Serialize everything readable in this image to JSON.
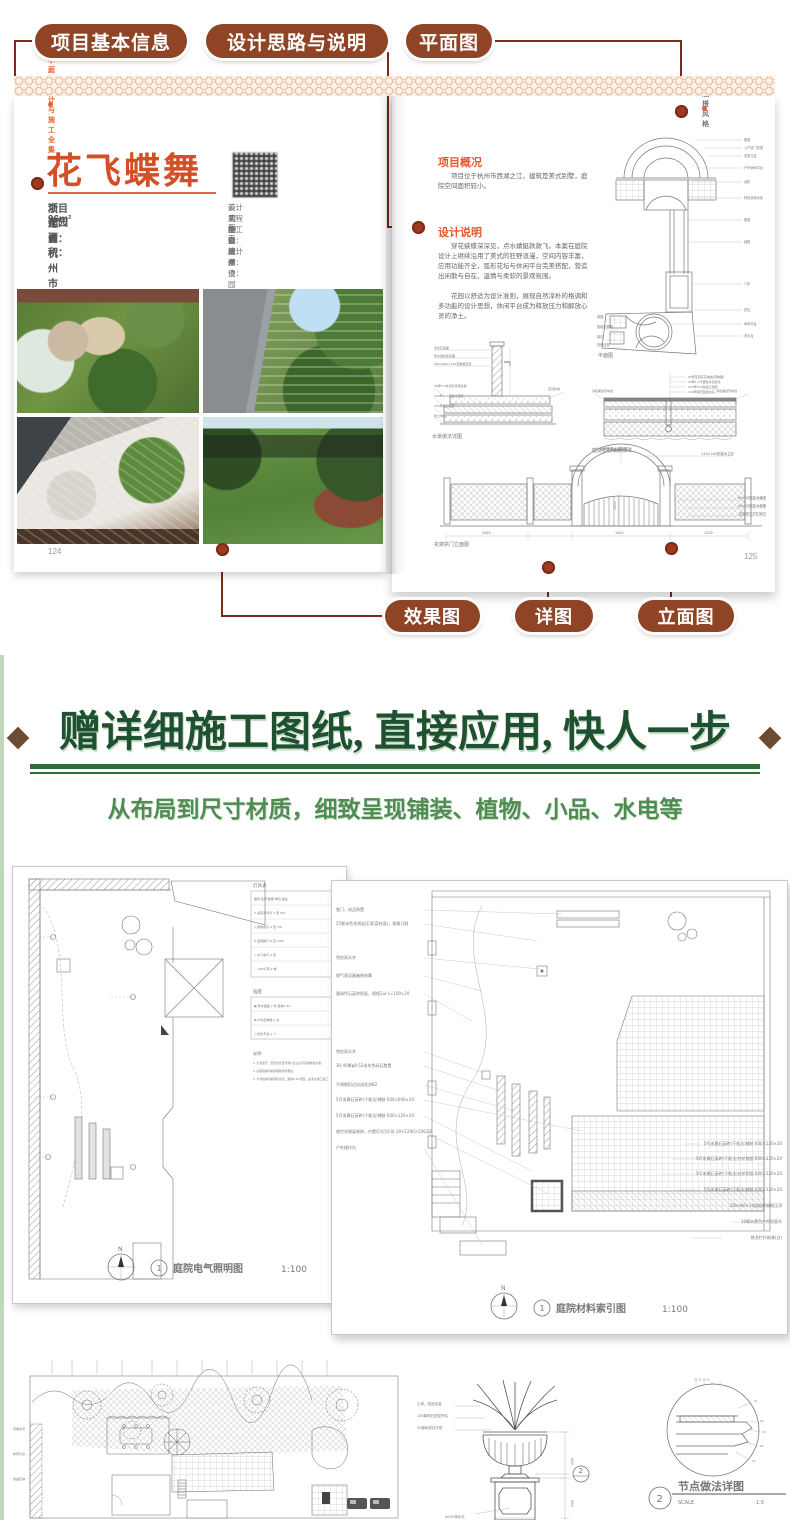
{
  "colors": {
    "pill": "#8e4425",
    "connector": "#7a2b19",
    "accent_orange": "#e25a2d",
    "title_red": "#d34f28",
    "headline_green": "#1d5130",
    "subtitle_green": "#4e8c52",
    "rule_green": "#2c6b3c",
    "diamond_brown": "#6b4c33"
  },
  "callouts": {
    "top": [
      "项目基本信息",
      "设计思路与说明",
      "平面图"
    ],
    "bottom": [
      "效果图",
      "详图",
      "立面图"
    ]
  },
  "book": {
    "left_page": {
      "header": "小庭院设计与施工全集",
      "title": "花飞蝶舞",
      "info": [
        {
          "label": "项目地点：",
          "value": "浙江省杭州市"
        },
        {
          "label": "花园面积：",
          "value": "96m²"
        }
      ],
      "specs": [
        {
          "label": "设计风格：",
          "value": "美式混搭"
        },
        {
          "label": "工程造价：",
          "value": "12 万"
        },
        {
          "label": "施工周期：",
          "value": "60 天"
        },
        {
          "label": "设 计 师：",
          "value": "张成度"
        },
        {
          "label": "设计单位：",
          "value": "杭州漫园园林工程有限公司"
        }
      ],
      "page_number": "124"
    },
    "right_page": {
      "header": "混搭风格",
      "overview_heading": "项目概况",
      "overview_text": "项目位于杭州市西湖之江，建筑是美式别墅，庭院空间面积较小。",
      "design_heading": "设计说明",
      "design_para1": "穿花蛱蝶深深见，点水蜻蜓款款飞。本案在庭院设计上继续沿用了美式的狂野浪漫，空间内容丰富，应用功能齐全，弧形花坛与休闲平台完美搭配，营造出闲散与自在、温情与柔软的景观氛围。",
      "design_para2": "花园以舒适为设计准则，展现自然淳朴的格调和多功能的设计思想，休闲平台成为释放压力和解放心灵的净土。",
      "page_number": "125"
    }
  },
  "plan": {
    "caption": "平面图",
    "labels_right": [
      "围墙",
      "入户拱门花架",
      "花架立柱",
      "户外休闲平台",
      "台阶",
      "特色景墙水景",
      "围墙",
      "绿篱",
      "汀步",
      "花坛",
      "休闲平台",
      "洗手台"
    ],
    "labels_left": [
      "菜园",
      "智能信报箱",
      "置石",
      "特色坐凳"
    ]
  },
  "water": {
    "caption": "水景做法详图",
    "labels_left": [
      "文化石贴面",
      "防水层拉毛处理",
      "200×600×120花岗岩压顶"
    ],
    "labels_bottom": [
      "30厚1:3水泥砂浆结合层",
      "100厚C15混凝土垫层",
      "150厚碎石垫层",
      "素土夯实"
    ],
    "label_right": "压顶找坡"
  },
  "paving": {
    "caption": "庭院石材铺装做法",
    "labels_top": [
      "50厚芝麻灰花岗岩(荔枝面)",
      "30厚1:3干硬性水泥砂浆",
      "100厚C15混凝土垫层",
      "150厚碎石垫层夯实"
    ],
    "label_left": "深色美缝剂勾缝",
    "label_right": "深色美缝剂勾缝"
  },
  "elevation": {
    "caption": "花架拱门立面图",
    "label_top": "成品防腐木花架拱门",
    "labels_right": [
      "240×240防腐木立柱",
      "60×40防腐木横梁",
      "40×30防腐木格栅",
      "成品铁艺护栏刷白"
    ],
    "dims": [
      "2463",
      "1400",
      "1250"
    ],
    "dim_height": "1500"
  },
  "promo": {
    "headline": "赠详细施工图纸, 直接应用, 快人一步",
    "subtitle": "从布局到尺寸材质，细致呈现铺装、植物、小品、水电等"
  },
  "sheet_electric": {
    "bubble": "1",
    "caption": "庭院电气照明图",
    "scale": "1:100",
    "north": "N",
    "legend_title": "灯具表",
    "legend_headers": "图例  名称  数量 单位 备注",
    "legend_rows": [
      "⊙  庭院草坪灯  7  套  5W",
      "▷  插地射灯  4  套  7W",
      "♀  庭院壁灯  8  套  10W",
      "◇  水下射灯  4  套",
      "—  LED灯带  2  卷"
    ],
    "legend2_title": "插座",
    "legend2_rows": [
      "▣  防水插座  2  处  距地0.3m",
      "⊠  户外配电箱  1  台",
      "◻  防水开关  1  个"
    ],
    "notes_title": "说明:",
    "notes": [
      "1. 灯具型号、安装方式及外观以业主认可实物样品为准。",
      "2. 庭院线路均采用埋地穿管敷设。",
      "3. 户外插座均采用防水型，距地0.3m安装，由专业电工施工。"
    ]
  },
  "sheet_material": {
    "bubble": "1",
    "caption": "庭院材料索引图",
    "scale": "1:100",
    "north": "N",
    "left_annotations": [
      "铁门，成品购置",
      "25厚米色花岗岩压顶(荔枝面)，规格订制",
      "免检雨水井",
      "燃气表设备箱装饰罩",
      "墨绿色石英砖贴面，规格2㎡ L=100×20",
      "免检雨水井",
      "30-40厚φ9-52米灰色砾石散置",
      "不锈钢扣边自流花池B2",
      "5号米黄石英砖(干粘法)铺装 600×600×20",
      "5号米黄石英砖(干粘法)铺装 600×120×20",
      "镂空花钢架装饰，内置灯光为C形 20×1200×500.B2",
      "户外操作台"
    ],
    "right_annotations": [
      "5号米黄石英砖(干粘法)铺装 600×120×20",
      "5号米黄石英砖(干粘法)台阶踏面 600×120×20",
      "5号米黄石英砖(干粘法)台阶侧面 600×120×20",
      "5号米黄石英砖(干粘法)铺装 600×120×20",
      "220×60×10烧结砖侧砌压顶",
      "10厚米黄色户外防腐木",
      "铁艺栏杆刷漆(白)"
    ]
  },
  "planting": {
    "labels": [
      "景墙水景",
      "休闲平台",
      "成品花钵"
    ]
  },
  "urn": {
    "labels": [
      "土球，成品安装",
      "100厚碎石垫层夯实",
      "30厚砂浆找平层"
    ],
    "dim_upper": "400",
    "dim_lower": "500",
    "drain": "Φ100排水孔",
    "bubble": "2"
  },
  "node_detail": {
    "bubble": "2",
    "caption": "节点做法详图",
    "scale_label": "SCALE",
    "scale_value": "1:5"
  }
}
